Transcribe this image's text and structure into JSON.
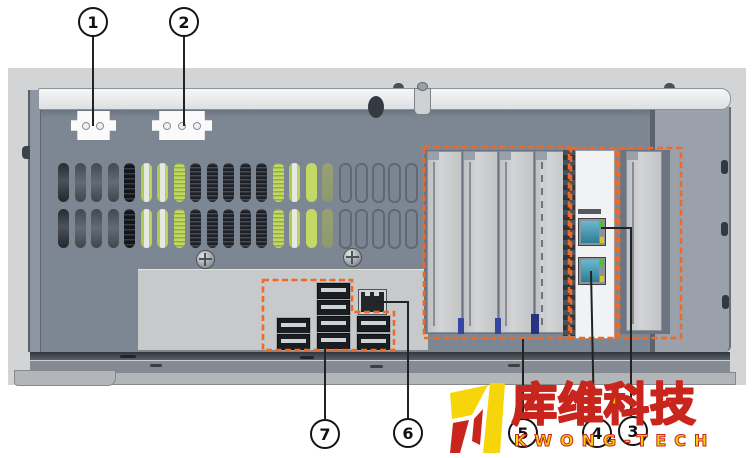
{
  "figure": {
    "type": "hardware-rear-panel-diagram",
    "accent_orange": "#EC6B28",
    "callouts": [
      {
        "label": "1",
        "cx": 93,
        "cy": 22,
        "path": [
          [
            93,
            36
          ],
          [
            93,
            126
          ]
        ]
      },
      {
        "label": "2",
        "cx": 184,
        "cy": 22,
        "path": [
          [
            184,
            36
          ],
          [
            184,
            126
          ]
        ]
      },
      {
        "label": "3",
        "cx": 633,
        "cy": 431,
        "path": [
          [
            601,
            228
          ],
          [
            631,
            228
          ],
          [
            631,
            416
          ]
        ]
      },
      {
        "label": "4",
        "cx": 597,
        "cy": 433,
        "path": [
          [
            591,
            271
          ],
          [
            594,
            418
          ]
        ]
      },
      {
        "label": "5",
        "cx": 523,
        "cy": 433,
        "path": [
          [
            523,
            339
          ],
          [
            523,
            418
          ]
        ]
      },
      {
        "label": "6",
        "cx": 408,
        "cy": 433,
        "path": [
          [
            374,
            302
          ],
          [
            408,
            302
          ],
          [
            408,
            418
          ]
        ]
      },
      {
        "label": "7",
        "cx": 325,
        "cy": 434,
        "path": [
          [
            325,
            347
          ],
          [
            325,
            419
          ]
        ]
      }
    ],
    "watermark": {
      "text_cn": "库维科技",
      "text_en": "KWONG-TECH",
      "yellow": "#F6D60A",
      "red": "#C8251C"
    },
    "vents": {
      "row_tops": [
        163,
        209
      ],
      "left": 58,
      "pitch": 16.52,
      "pattern": [
        "dark",
        "mid",
        "mid",
        "mid",
        "vdark",
        "greenhi",
        "greenhi",
        "greentex",
        "fins",
        "fins",
        "fins",
        "fins",
        "fins",
        "greentex",
        "greenhi",
        "green",
        "olive",
        "empty",
        "empty",
        "empty",
        "empty",
        "empty"
      ]
    },
    "io": {
      "usb_ports": [
        [
          277,
          318
        ],
        [
          277,
          334
        ],
        [
          317,
          283
        ],
        [
          317,
          300
        ],
        [
          317,
          316
        ],
        [
          317,
          333
        ],
        [
          357,
          316
        ],
        [
          357,
          334
        ]
      ],
      "usb_count": 8,
      "ethernet_count": 1
    },
    "power_connectors": [
      {
        "name": "power-connector-2pin",
        "pins": 2
      },
      {
        "name": "power-connector-3pin",
        "pins": 3
      }
    ],
    "lan_card": {
      "port_count": 2
    },
    "expansion_slots": {
      "blank_covers": 5
    }
  }
}
